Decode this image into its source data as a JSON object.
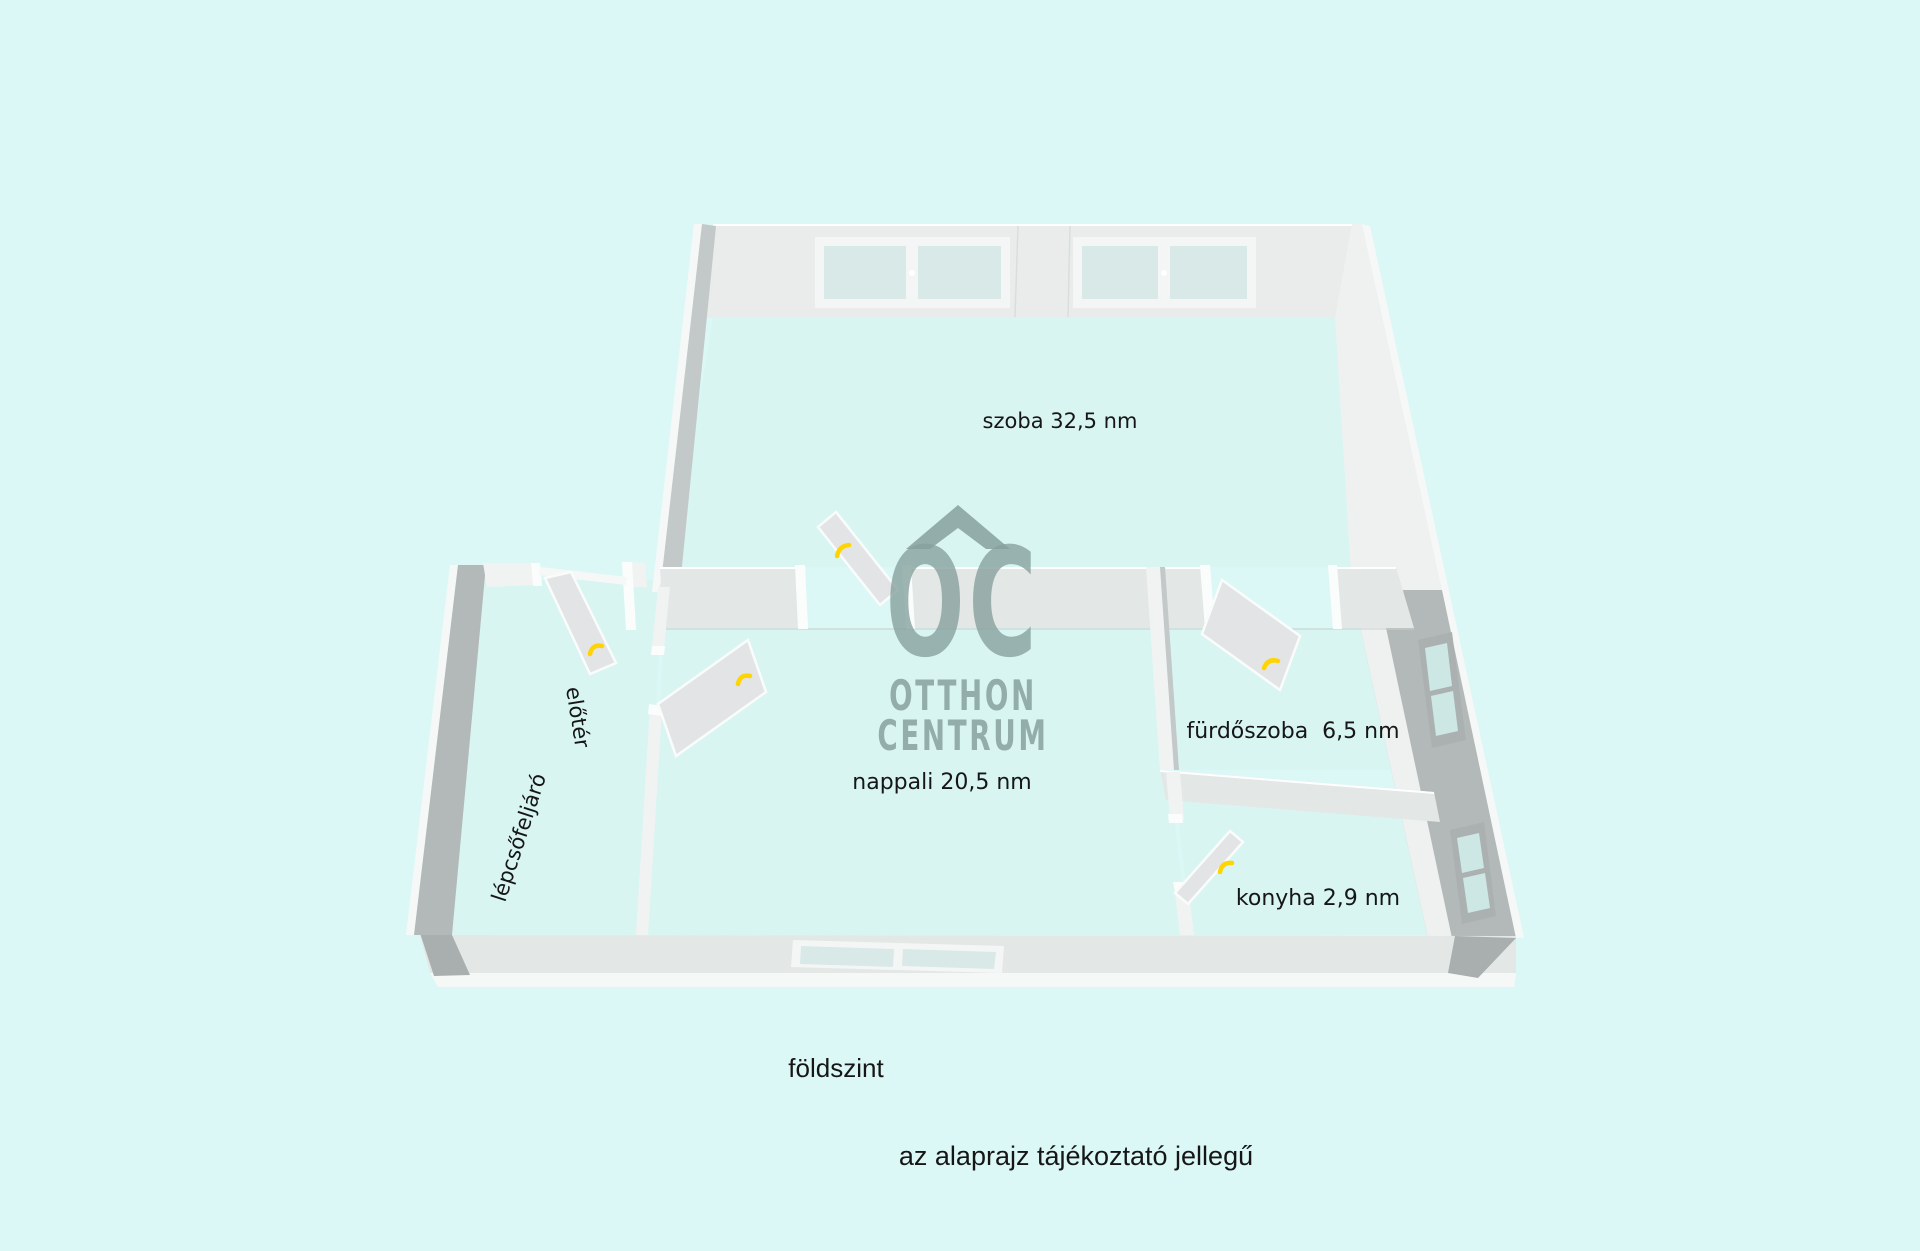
{
  "floorplan": {
    "rooms": [
      {
        "id": "szoba",
        "label": "szoba 32,5 nm"
      },
      {
        "id": "nappali",
        "label": "nappali 20,5 nm"
      },
      {
        "id": "furdoszoba",
        "label": "fürdőszoba  6,5 nm"
      },
      {
        "id": "konyha",
        "label": "konyha 2,9 nm"
      },
      {
        "id": "eloter",
        "label": "előtér"
      },
      {
        "id": "lepcsofeljaro",
        "label": "lépcsőfeljáró"
      }
    ],
    "captions": {
      "floor_level": "földszint",
      "disclaimer": "az alaprajz tájékoztató jellegű"
    },
    "watermark": {
      "monogram": "OC",
      "line1": "OTTHON",
      "line2": "CENTRUM",
      "color": "#87a19d"
    },
    "colors": {
      "background": "#dcf8f6",
      "floor": "#d8f5f2",
      "wall_face": "#e9eceb",
      "wall_side_dark": "#b3b9b8",
      "wall_white": "#f6f8f8",
      "interior_band": "#e3e7e6",
      "door_leaf": "#e2e4e5",
      "door_handle": "#ffd400",
      "window_glass": "#d9e9e7",
      "label_text": "#161616"
    }
  }
}
